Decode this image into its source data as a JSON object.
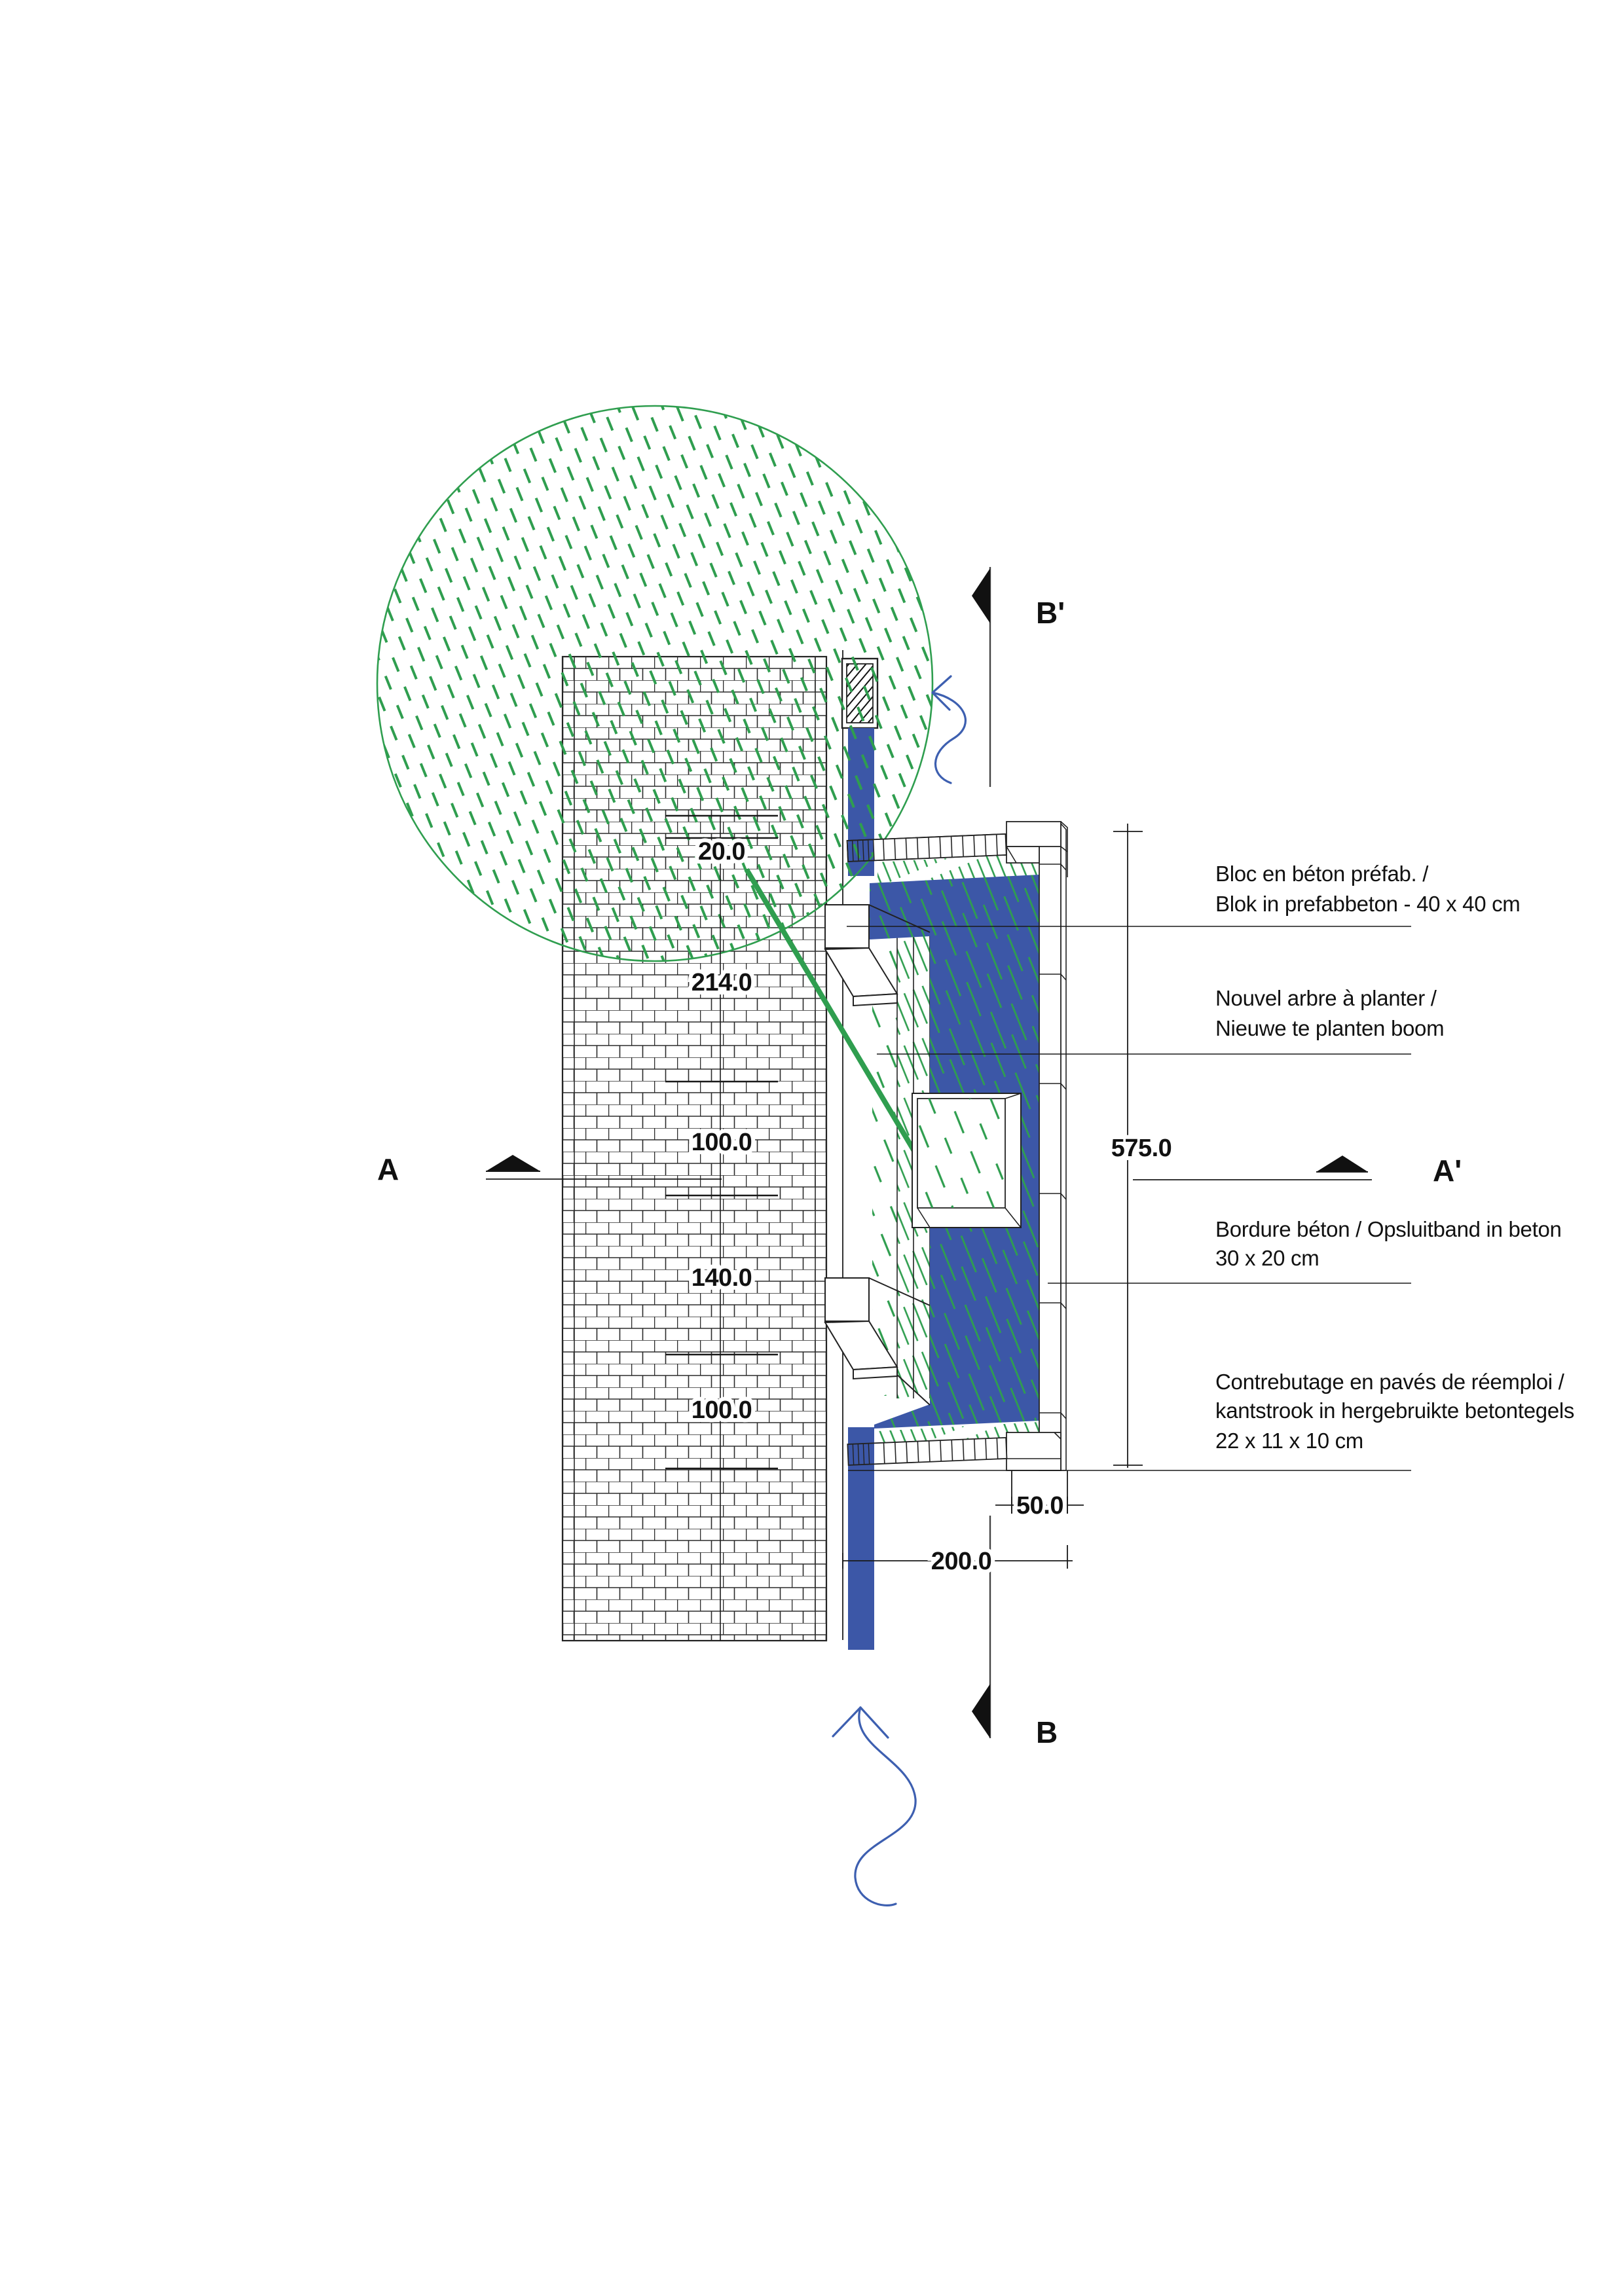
{
  "drawing_type": "landscape construction detail plan",
  "annotations": {
    "bloc": {
      "line1": "Bloc en béton préfab. /",
      "line2": "Blok in prefabbeton - 40 x 40 cm"
    },
    "arbre": {
      "line1": "Nouvel arbre à planter /",
      "line2": "Nieuwe te planten boom"
    },
    "bordure": {
      "line1": "Bordure béton / Opsluitband in beton",
      "line2": "30 x 20 cm"
    },
    "contrebutage": {
      "line1": "Contrebutage en pavés de réemploi /",
      "line2": "kantstrook in hergebruikte betontegels",
      "line3": "22 x 11 x 10 cm"
    }
  },
  "dimensions": {
    "seg20": "20.0",
    "seg214": "214.0",
    "seg100a": "100.0",
    "seg140": "140.0",
    "seg100b": "100.0",
    "total": "575.0",
    "offset50": "50.0",
    "offset200": "200.0"
  },
  "sections": {
    "a": "A",
    "a_prime": "A'",
    "b": "B",
    "b_prime": "B'"
  },
  "colors": {
    "blue": "#3c57a7",
    "green": "#2f9e4f",
    "line": "#1a1a1a"
  }
}
